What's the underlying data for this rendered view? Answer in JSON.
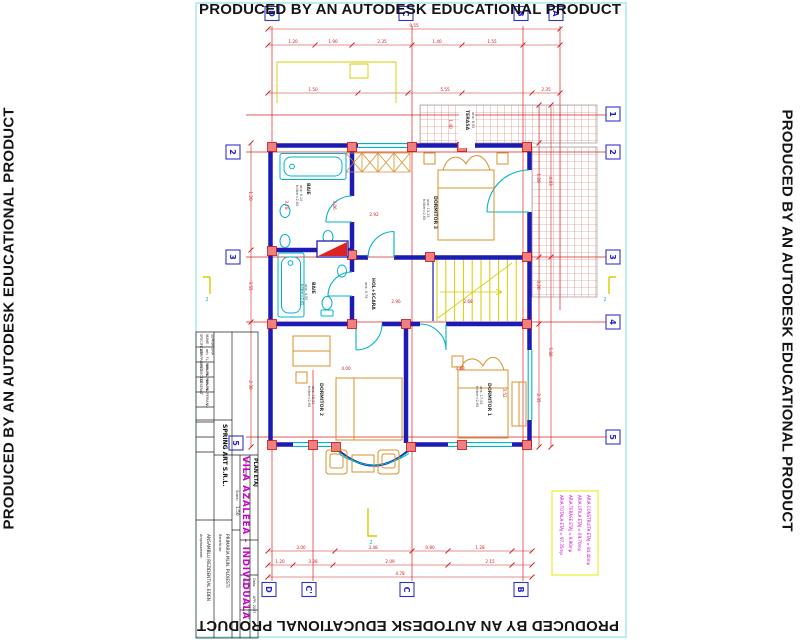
{
  "watermark": {
    "text": "PRODUCED BY AN AUTODESK EDUCATIONAL PRODUCT"
  },
  "title_block": {
    "company": "SPRING ART S.R.L.",
    "project": "VILA AZALEEA - INDIVIDUALA",
    "spec_header": "SPECIFICATIE",
    "name_header": "NUME",
    "sign_header": "SEMNATURA",
    "row1_role": "SEF PROIECT",
    "row1_name": "arh. FL. PERIANU",
    "row2_role": "PROIECTAT",
    "row2_name": "arh. FL. PERIANU",
    "row3_role": "DESENAT",
    "row3_name": "arh. FL. PERIANU",
    "scale_label": "Scara:",
    "scale": "1:50",
    "beneficiary_label": "Beneficiar:",
    "beneficiary": "PRIMARIA MUN. PLOIESTI",
    "site_label": "Amplasament:",
    "site": "ANSAMBLU REZIDENTIAL EDEN",
    "sheet_label": "Titlu plansa:",
    "sheet": "PLAN ETAJ",
    "phase_label": "Faza:",
    "phase": "P.A.C.",
    "project_no_label": "Proiect nr:",
    "project_no": "37.A0/06",
    "date_label": "Data:",
    "date": "APR. 2007"
  },
  "areas_box": {
    "lines": [
      "ARIA TOTALA ETAJ = 97.35mp",
      "ARIA TERASE ETAJ = 8.90mp",
      "ARIA UTILA ETAJ = 69.70mp",
      "ARIA CONSTRUITA ETAJ = 84.40mp"
    ]
  },
  "grid": {
    "top": [
      "D",
      "C",
      "B",
      "A"
    ],
    "bottom": [
      "D",
      "C'",
      "C",
      "B"
    ],
    "right": [
      "1",
      "2",
      "3",
      "4",
      "5"
    ],
    "left": [
      "2",
      "3",
      "5"
    ]
  },
  "rooms": [
    {
      "name": "TERASA",
      "area": "aria: 8.90"
    },
    {
      "name": "DORMITOR 3",
      "area": "aria: 13.15",
      "height": "h:liber=2.65"
    },
    {
      "name": "BAIE",
      "area": "aria: 6.10",
      "height": "h:liber=2.65"
    },
    {
      "name": "BAIE",
      "area": "aria: 4.50",
      "height": "h:liber=2.65"
    },
    {
      "name": "HOL+SCARA",
      "area": "aria: 9.79"
    },
    {
      "name": "DORMITOR 2",
      "area": "aria: 18.21",
      "height": "h:liber=2.65"
    },
    {
      "name": "DORMITOR 1",
      "area": "aria: 17.05",
      "height": "h:liber=2.65"
    }
  ],
  "section": {
    "label": "2"
  },
  "dims": [
    "9.55",
    "1.20",
    "1.90",
    "2.35",
    "1.40",
    "1.55",
    "1.50",
    "5.55",
    "2.35",
    "3.00",
    "3.48",
    "0.80",
    "1.28",
    "1.20",
    "3.28",
    "2.09",
    "2.15",
    "4.78",
    "1.20",
    "3.55",
    "2.30",
    "1.28",
    "3.26",
    "2.35",
    "4.03",
    "5.88",
    "2.92",
    "3.78",
    "3.06",
    "2.96",
    "2.68",
    "4.00",
    "3.68",
    "3.52",
    "1.40"
  ],
  "colors": {
    "wall": "#1c1cb4",
    "axis": "#dd2222",
    "fixture": "#00b4c8",
    "furniture": "#d89028",
    "stairs": "#d8cc00",
    "accent_magenta": "#cc00cc",
    "frame_cyan": "#7adce0",
    "bubble_blue": "#3333cc"
  }
}
